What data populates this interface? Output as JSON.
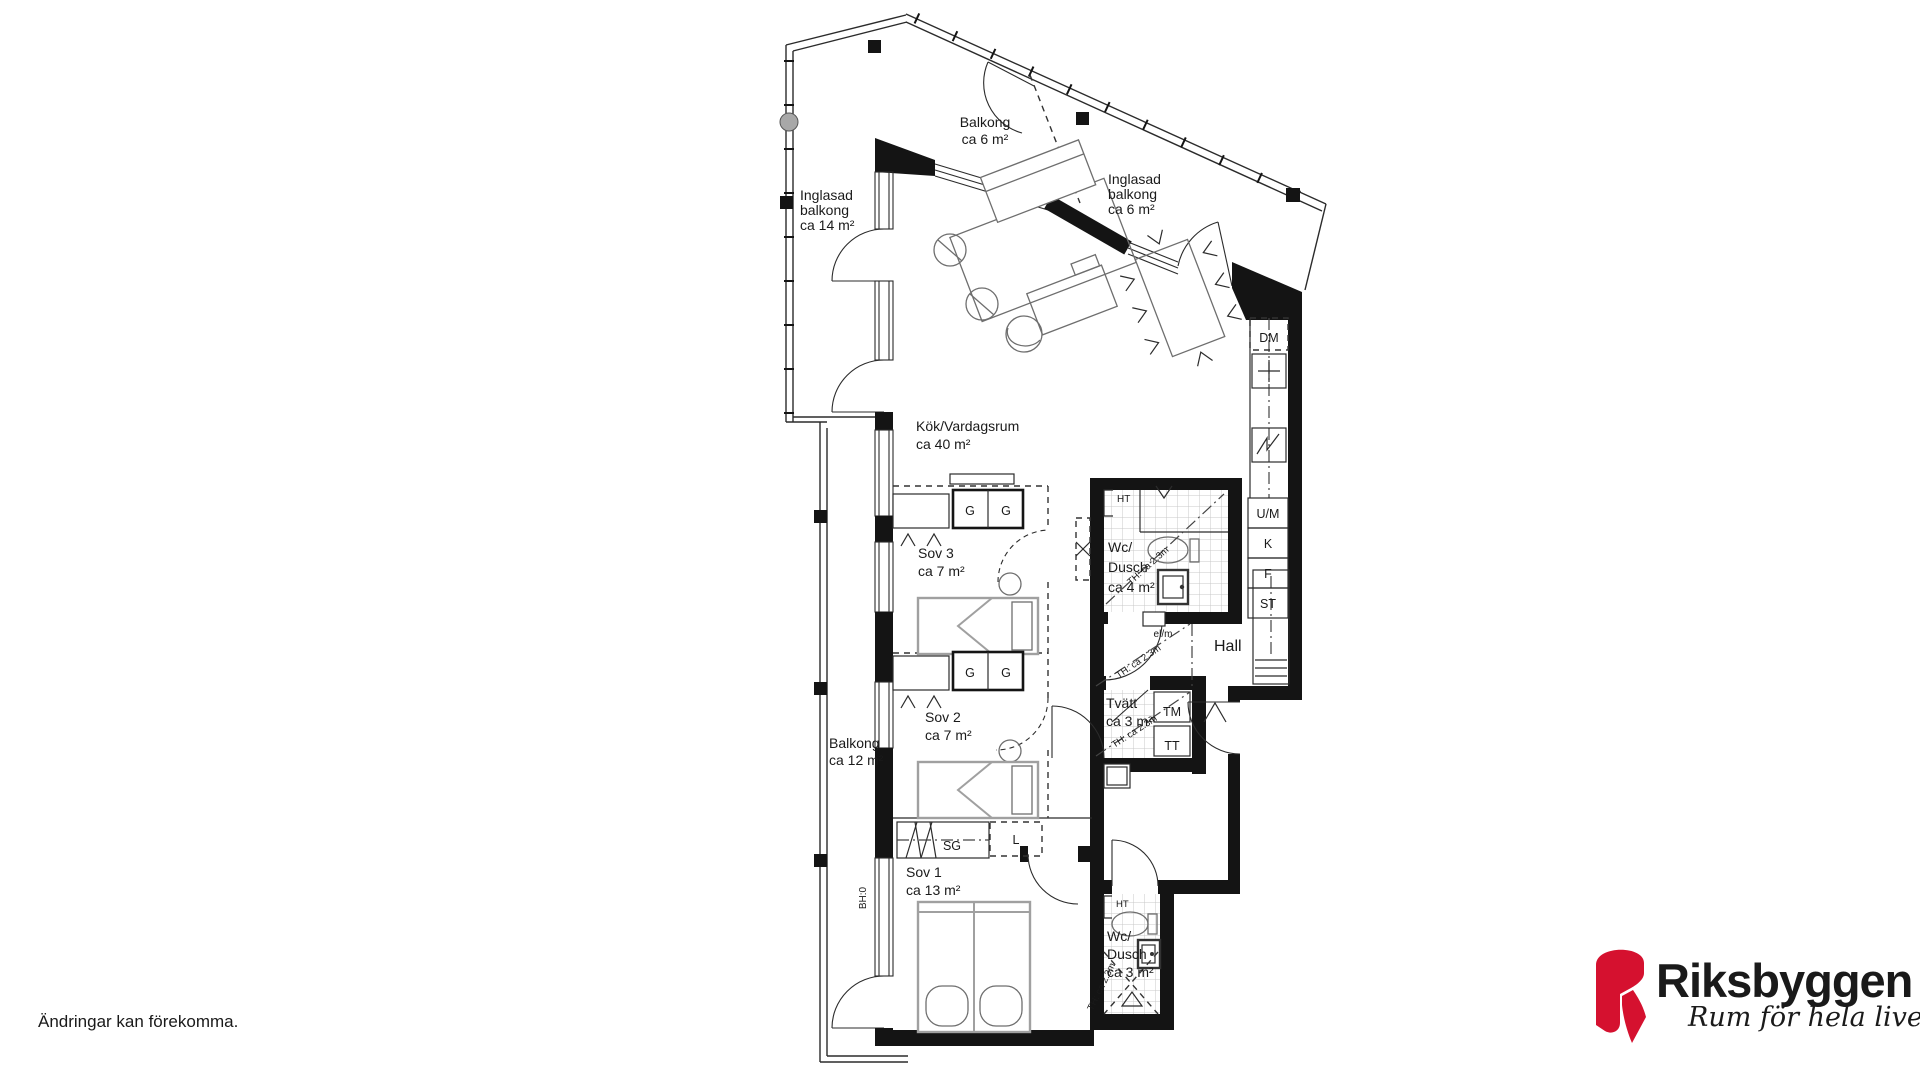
{
  "disclaimer": "Ändringar kan förekomma.",
  "brand": {
    "name": "Riksbyggen",
    "tagline": "Rum för hela livet",
    "red": "#d5112f",
    "gray": "#8a8b8e"
  },
  "rooms": {
    "balkong_top": {
      "name": "Balkong",
      "area": "ca 6 m²"
    },
    "inglasad_left": {
      "name1": "Inglasad",
      "name2": "balkong",
      "area": "ca 14 m²"
    },
    "inglasad_right": {
      "name1": "Inglasad",
      "name2": "balkong",
      "area": "ca 6 m²"
    },
    "kok": {
      "name": "Kök/Vardagsrum",
      "area": "ca 40 m²"
    },
    "sov3": {
      "name": "Sov 3",
      "area": "ca 7 m²"
    },
    "sov2": {
      "name": "Sov 2",
      "area": "ca 7 m²"
    },
    "sov1": {
      "name": "Sov 1",
      "area": "ca 13 m²"
    },
    "wc4": {
      "name1": "Wc/",
      "name2": "Dusch",
      "area": "ca 4 m²"
    },
    "wc3": {
      "name1": "Wc/",
      "name2": "Dusch",
      "area": "ca 3 m²"
    },
    "tvatt": {
      "name": "Tvätt",
      "area": "ca 3 m²"
    },
    "hall": {
      "name": "Hall"
    },
    "balkong_left": {
      "name": "Balkong",
      "area": "ca 12 m²"
    }
  },
  "fixtures": {
    "dm": "DM",
    "um": "U/M",
    "k": "K",
    "f": "F",
    "st": "ST",
    "tm": "TM",
    "tt": "TT",
    "g": "G",
    "sg": "SG",
    "l": "L",
    "ht": "HT",
    "elm": "el/m"
  },
  "annotations": {
    "th": "TH: ca 2.3m",
    "bh": "BH:0"
  }
}
